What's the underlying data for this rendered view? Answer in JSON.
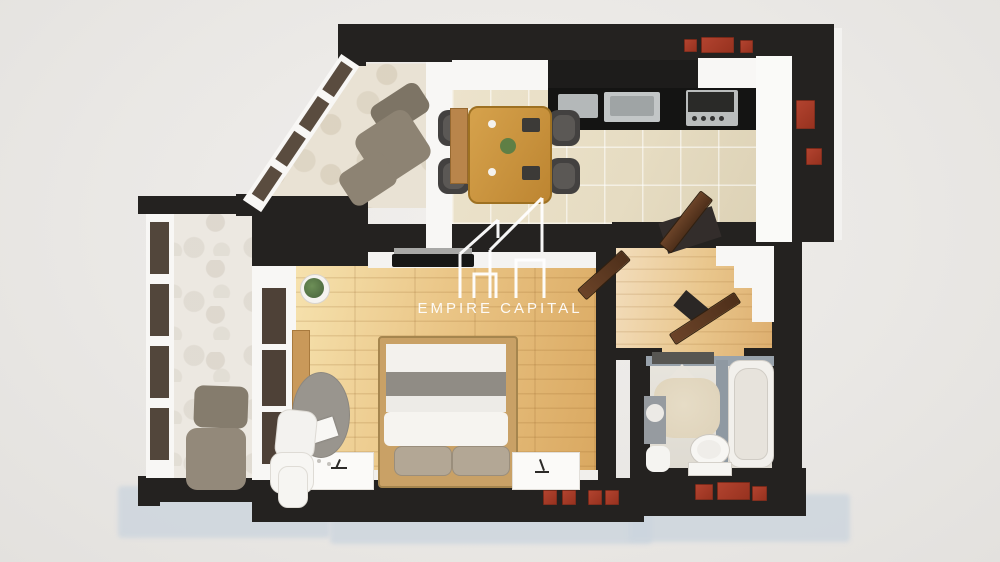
{
  "watermark": {
    "logo_icon": "empire-capital-buildings-logo",
    "text": "EMPIRE CAPITAL",
    "color": "#ffffff"
  },
  "palette": {
    "background": "#eae8e5",
    "wall": "#242220",
    "brick_accent": "#a93b2c",
    "wood_floor": "#eac586",
    "kitchen_tile": "#e6dcc2",
    "balcony_marble": "#ece8e1",
    "bathroom_wall": "#98a2ab",
    "door_wood": "#5e3b26",
    "drop_shadow": "#ccd5de"
  },
  "scene": {
    "type": "3d-apartment-floor-plan-render",
    "rooms": [
      {
        "name": "kitchen-dining"
      },
      {
        "name": "bedroom-living"
      },
      {
        "name": "hallway"
      },
      {
        "name": "bathroom"
      },
      {
        "name": "balcony-top-left"
      },
      {
        "name": "balcony-left"
      }
    ],
    "furniture": [
      "dining-table",
      "dining-chairs",
      "kitchen-counter",
      "sink",
      "stove",
      "double-bed",
      "pillows",
      "nightstands",
      "tv",
      "desk-round-table",
      "desk-chair",
      "potted-plant",
      "lounge-armchair",
      "ottoman",
      "bathtub",
      "toilet",
      "vanity-sink",
      "shower",
      "entry-door",
      "interior-doors",
      "wardrobe-steps"
    ]
  }
}
